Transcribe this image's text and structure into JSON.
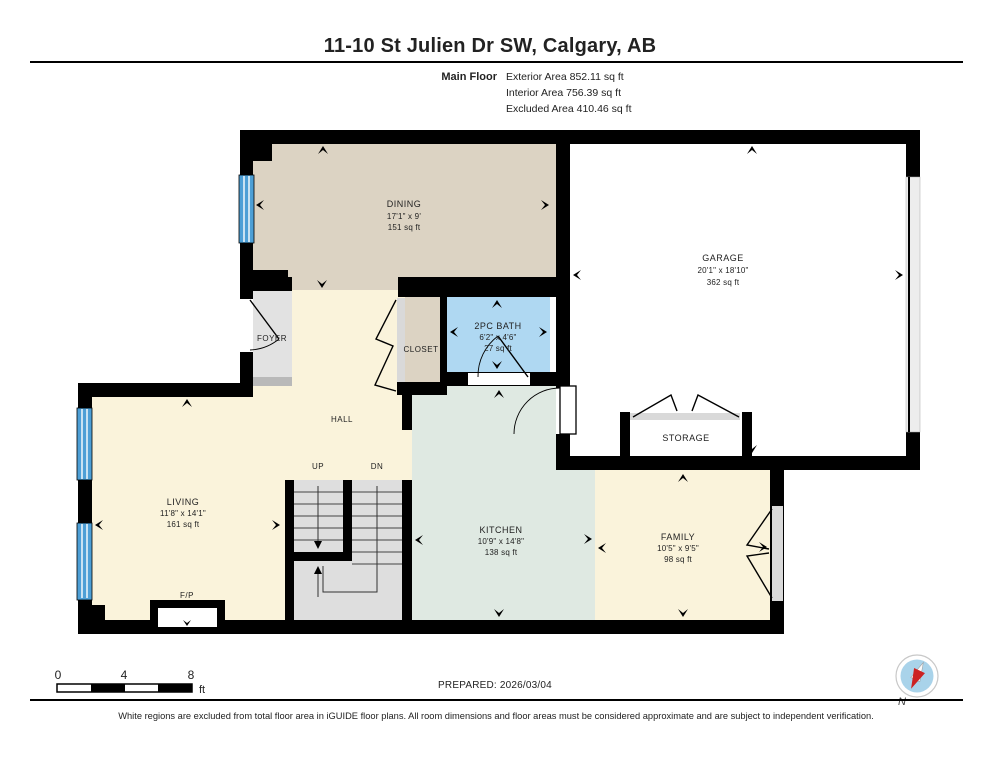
{
  "header": {
    "title": "11-10 St Julien Dr SW, Calgary, AB",
    "floor_label": "Main Floor",
    "areas": [
      "Exterior Area 852.11 sq ft",
      "Interior Area 756.39 sq ft",
      "Excluded Area 410.46 sq ft"
    ]
  },
  "rooms": {
    "dining": {
      "name": "DINING",
      "dims": "17'1\" x 9'",
      "area": "151 sq ft"
    },
    "garage": {
      "name": "GARAGE",
      "dims": "20'1\" x 18'10\"",
      "area": "362 sq ft"
    },
    "bath": {
      "name": "2PC BATH",
      "dims": "6'2\" x 4'6\"",
      "area": "27 sq ft"
    },
    "living": {
      "name": "LIVING",
      "dims": "11'8\" x 14'1\"",
      "area": "161 sq ft"
    },
    "kitchen": {
      "name": "KITCHEN",
      "dims": "10'9\" x 14'8\"",
      "area": "138 sq ft"
    },
    "family": {
      "name": "FAMILY",
      "dims": "10'5\" x 9'5\"",
      "area": "98 sq ft"
    },
    "foyer": {
      "name": "FOYER"
    },
    "closet": {
      "name": "CLOSET"
    },
    "hall": {
      "name": "HALL"
    },
    "storage": {
      "name": "STORAGE"
    },
    "fireplace": {
      "name": "F/P"
    },
    "stairs": {
      "up": "UP",
      "dn": "DN"
    }
  },
  "scale_bar": {
    "tick0": "0",
    "tick4": "4",
    "tick8": "8",
    "unit": "ft"
  },
  "footer": {
    "prepared": "PREPARED: 2026/03/04",
    "compass_label": "N",
    "disclaimer": "White regions are excluded from total floor area in iGUIDE floor plans. All room dimensions and floor areas must be considered approximate and are subject to independent verification."
  },
  "colors": {
    "wall": "#000000",
    "dining_tan": "#DCD3C3",
    "cream": "#FAF3DB",
    "kitchen_green": "#DFE9E2",
    "bath_blue": "#AFD8F2",
    "foyer_gray": "#E2E2E2",
    "stairs_gray": "#DEDEDE",
    "window_blue": "#4D9FD6",
    "threshold_gray": "#C9C9C9"
  }
}
